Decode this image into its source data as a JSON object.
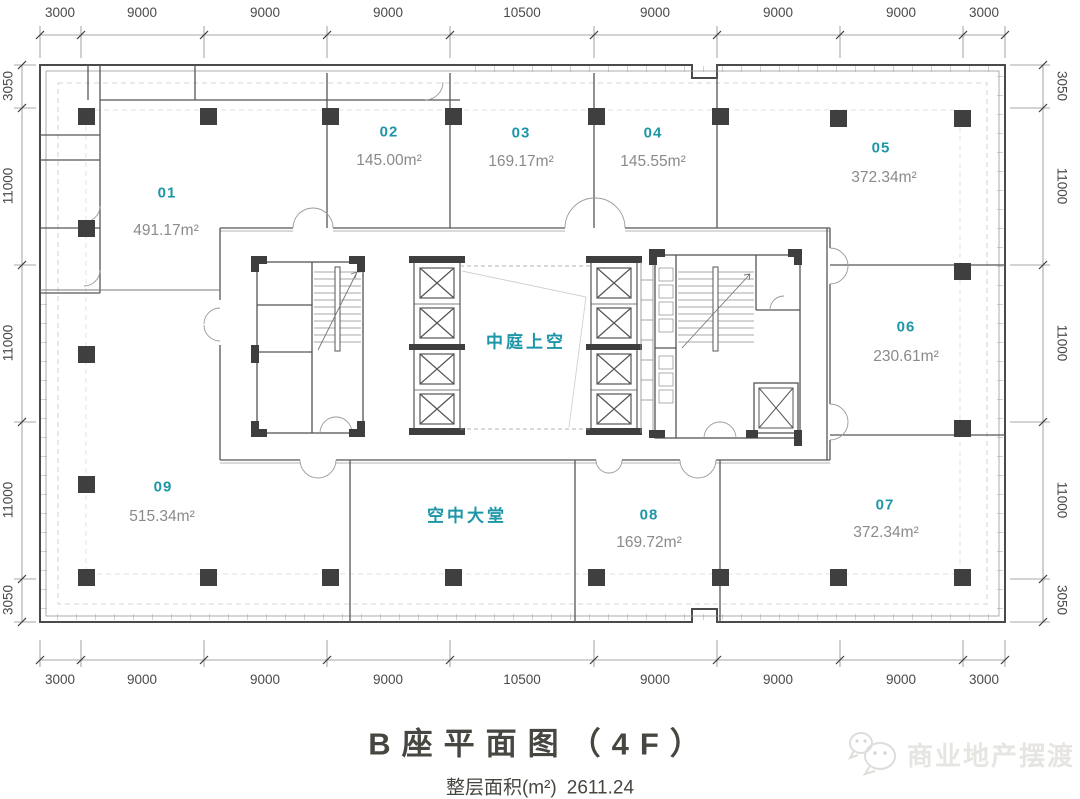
{
  "colors": {
    "accent_teal": "#1d96a8",
    "area_text": "#8a8a8a",
    "dimension_text": "#4a4a4a",
    "wall_dark": "#4a4a4a",
    "column_fill": "#3f3f3f",
    "title_text": "#474741",
    "watermark_text": "#e6e5e1"
  },
  "dimensions": {
    "top": [
      "3000",
      "9000",
      "9000",
      "9000",
      "10500",
      "9000",
      "9000",
      "9000",
      "3000"
    ],
    "bottom": [
      "3000",
      "9000",
      "9000",
      "9000",
      "10500",
      "9000",
      "9000",
      "9000",
      "3000"
    ],
    "left": [
      "3050",
      "11000",
      "11000",
      "11000",
      "3050"
    ],
    "right": [
      "3050",
      "11000",
      "11000",
      "11000",
      "3050"
    ]
  },
  "rooms": [
    {
      "id": "01",
      "area": "491.17m²"
    },
    {
      "id": "02",
      "area": "145.00m²"
    },
    {
      "id": "03",
      "area": "169.17m²"
    },
    {
      "id": "04",
      "area": "145.55m²"
    },
    {
      "id": "05",
      "area": "372.34m²"
    },
    {
      "id": "06",
      "area": "230.61m²"
    },
    {
      "id": "07",
      "area": "372.34m²"
    },
    {
      "id": "08",
      "area": "169.72m²"
    },
    {
      "id": "09",
      "area": "515.34m²"
    }
  ],
  "plan_labels": {
    "atrium": "中庭上空",
    "sky_lobby": "空中大堂"
  },
  "title": "B座平面图（4F）",
  "footer": {
    "area_label": "整层面积(m²)",
    "area_value": "2611.24"
  },
  "watermark": {
    "text": "商业地产摆渡",
    "icon": "chat-bubbles-icon"
  }
}
